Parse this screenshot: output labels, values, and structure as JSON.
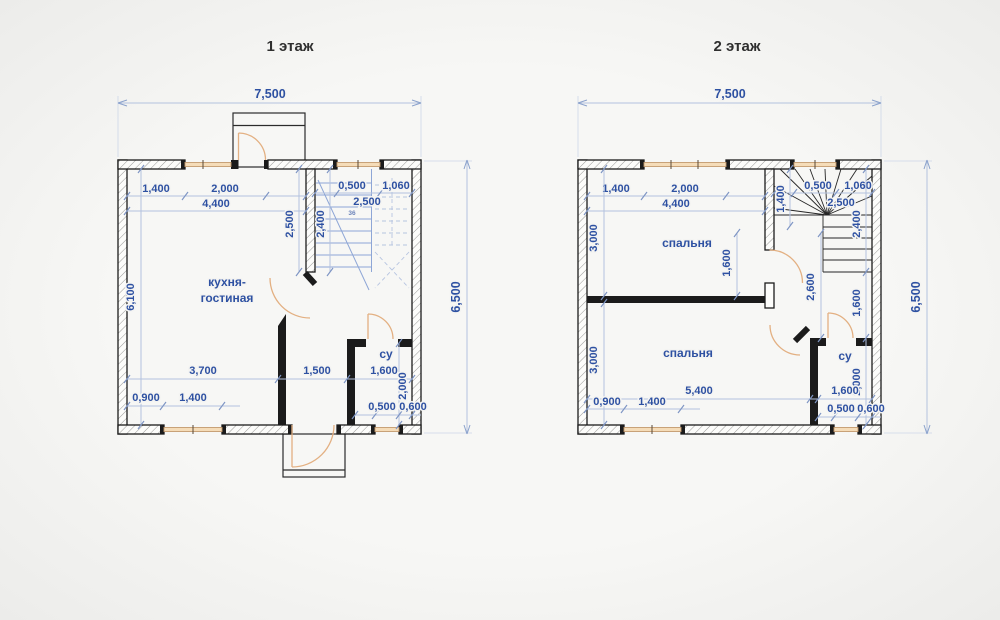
{
  "colors": {
    "dimension_blue": "#2e51a2",
    "dim_line_blue": "#b3c2de",
    "wall_black": "#1b1b1b",
    "window_tan": "#f5dcb8",
    "door_orange": "#e3b082",
    "stair_blue": "#8ea6d6",
    "title_dark": "#2f2f2f"
  },
  "floor1": {
    "title": "1 этаж",
    "overall": {
      "width": "7,500",
      "height": "6,500"
    },
    "rooms": {
      "kitchen_living_line1": "кухня-",
      "kitchen_living_line2": "гостиная",
      "bathroom": "су"
    },
    "dims": {
      "top_left_1": "1,400",
      "top_left_2": "2,000",
      "top_left_total": "4,400",
      "stair_top_1": "0,500",
      "stair_top_2": "1,060",
      "stair_top_total": "2,500",
      "stair_wall_height": "2,500",
      "stair_flight_height": "2,400",
      "left_interior_height": "6,100",
      "bottom_1": "3,700",
      "bottom_2": "1,500",
      "bottom_3": "1,600",
      "bathroom_height": "2,000",
      "bottom_left_offset": "0,900",
      "bottom_left_window": "1,400",
      "bathroom_window_offset": "0,500",
      "bathroom_window": "0,600",
      "stair_note": "36"
    }
  },
  "floor2": {
    "title": "2 этаж",
    "overall": {
      "width": "7,500",
      "height": "6,500"
    },
    "rooms": {
      "bedroom_top": "спальня",
      "bedroom_bottom": "спальня",
      "bathroom": "су"
    },
    "dims": {
      "top_left_1": "1,400",
      "top_left_2": "2,000",
      "top_left_total": "4,400",
      "stair_top_1": "0,500",
      "stair_top_2": "1,060",
      "stair_top_total": "2,500",
      "left_upper_height": "3,000",
      "left_lower_height": "3,000",
      "stair_left_depth": "1,400",
      "stair_flight_height": "2,400",
      "bedroom_door_offset": "1,600",
      "landing_height": "2,600",
      "landing_right": "1,600",
      "bottom_total": "5,400",
      "bottom_left_offset": "0,900",
      "bottom_left_window": "1,400",
      "bathroom_width": "1,600",
      "bathroom_height": "2,000",
      "bathroom_window_offset": "0,500",
      "bathroom_window": "0,600"
    }
  }
}
